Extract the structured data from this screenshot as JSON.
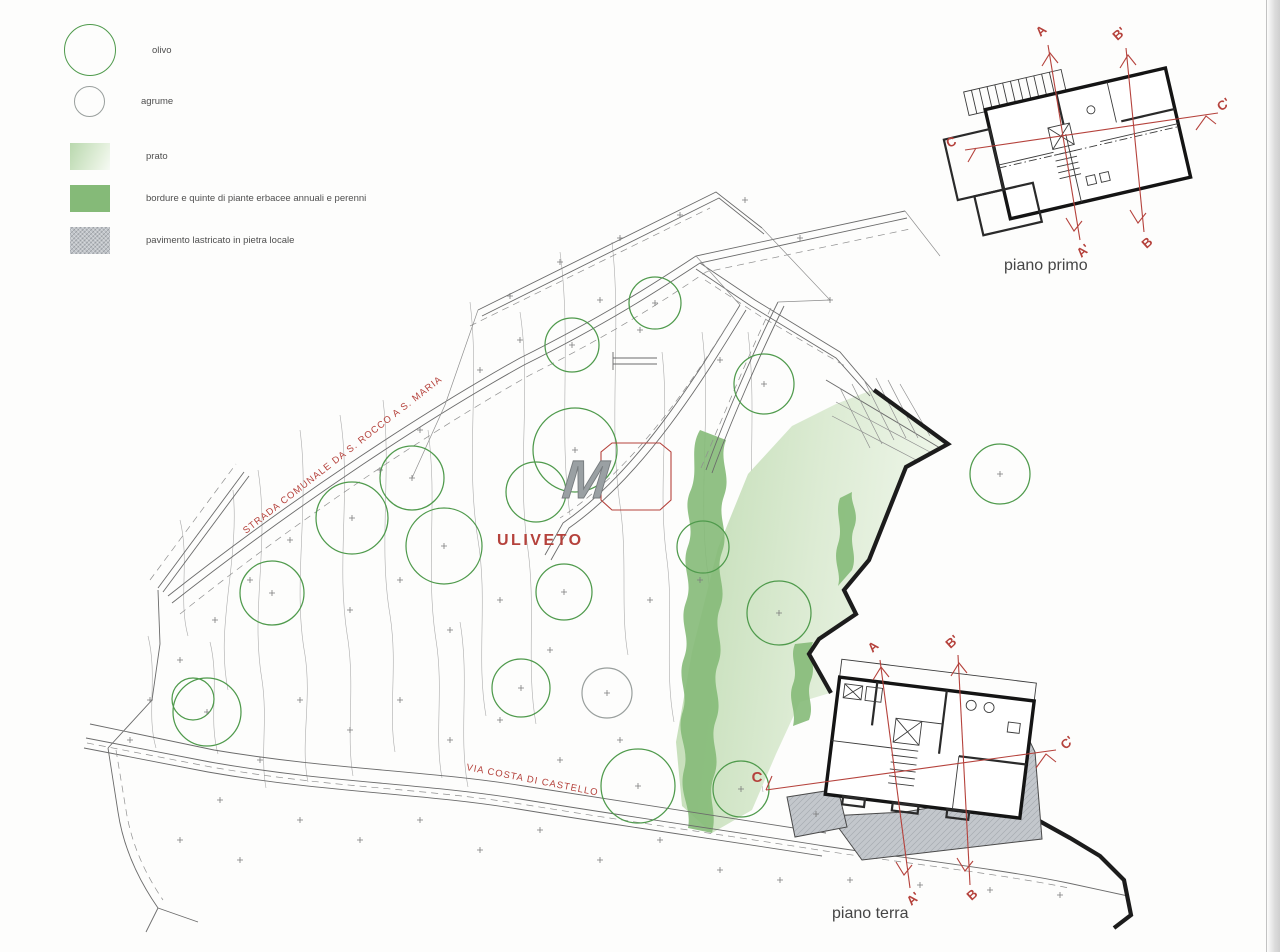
{
  "legend": {
    "items": [
      {
        "id": "olivo",
        "label": "olivo"
      },
      {
        "id": "agrume",
        "label": "agrume"
      },
      {
        "id": "prato",
        "label": "prato"
      },
      {
        "id": "bordure",
        "label": "bordure e quinte di piante erbacee annuali e perenni"
      },
      {
        "id": "paving",
        "label": "pavimento lastricato in pietra locale"
      }
    ]
  },
  "site": {
    "area_label": "ULIVETO",
    "upper_road_label": "STRADA COMUNALE DA S. ROCCO A S. MARIA",
    "lower_road_label": "VIA COSTA DI CASTELLO"
  },
  "plans": {
    "first_floor_title": "piano primo",
    "ground_floor_title": "piano terra",
    "sections": {
      "a": "A",
      "a_prime": "A'",
      "b": "B",
      "b_prime": "B'",
      "c": "C",
      "c_prime": "C'"
    }
  },
  "logo": {
    "letter": "M"
  },
  "colors": {
    "tree_green": "#4f9a4c",
    "agrume_gray": "#999f9d",
    "prato_light": "#e4f0dd",
    "prato_deep": "#b9d8ae",
    "bordure_green": "#85ba78",
    "paving_gray": "#bfc3c8",
    "red_accent": "#b5423c"
  }
}
